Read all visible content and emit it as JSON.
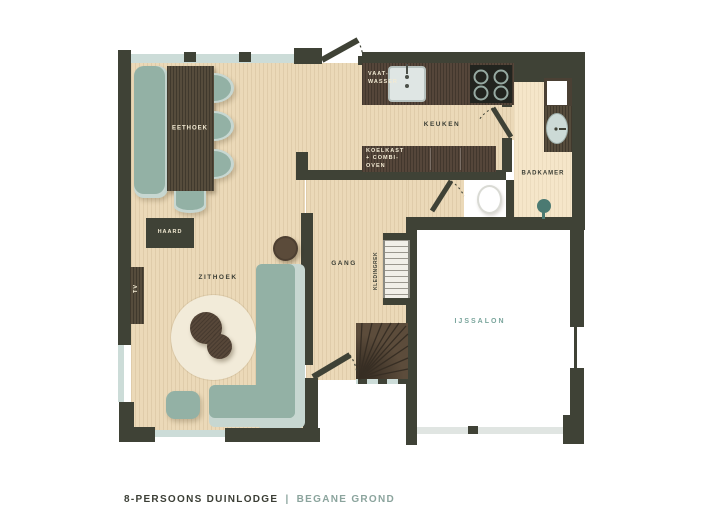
{
  "title_block": {
    "name": "8-PERSOONS DUINLODGE",
    "divider": "|",
    "floor": "BEGANE GROND"
  },
  "rooms": {
    "eethoek": "EETHOEK",
    "zithoek": "ZITHOEK",
    "keuken": "KEUKEN",
    "gang": "GANG",
    "badkamer": "BADKAMER",
    "ijssalon": "IJSSALON"
  },
  "fixtures": {
    "haard": "HAARD",
    "tv": "TV",
    "vaatwasser": "VAAT-\nWASSER",
    "koelkast": "KOELKAST\n+ COMBI-\nOVEN",
    "kledingrek": "KLEDINGREK"
  },
  "palette": {
    "wall": "#3F4236",
    "wood_floor": "#EBD9B8",
    "bath_floor": "#F5E6C9",
    "counter_wood": "#55463A",
    "furniture_teal": "#93B1A5",
    "furniture_teal_light": "#C7D7D1",
    "rug_cream": "#F2EBD9",
    "window_glass": "#CCDCD8",
    "accent_teal_text": "#7AA59C",
    "label_dark": "#3B3E35",
    "label_cream": "#F2EAD3"
  }
}
